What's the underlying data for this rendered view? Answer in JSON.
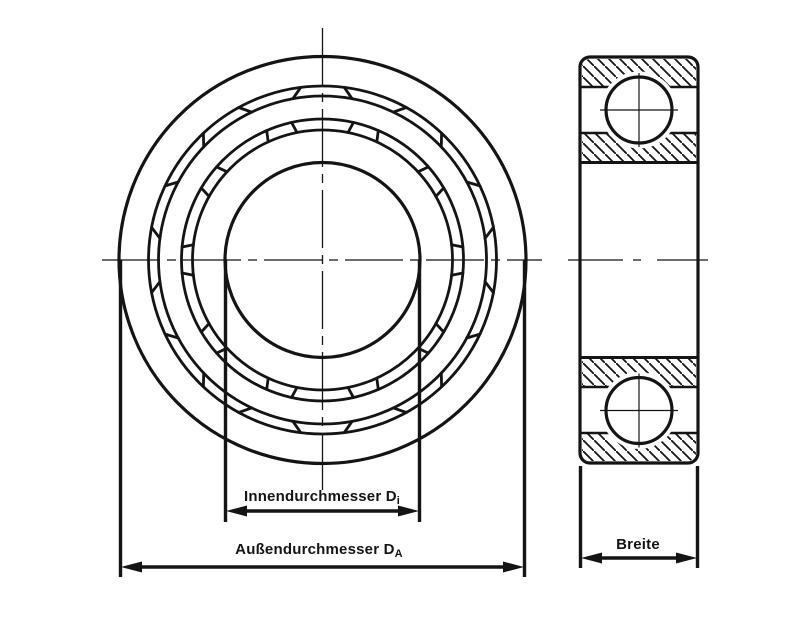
{
  "drawing": {
    "background": "#ffffff",
    "line_color": "#141414",
    "front_view": {
      "ball_positions": 10
    },
    "labels": {
      "inner_diameter": {
        "text": "Innendurchmesser D",
        "sub": "i"
      },
      "outer_diameter": {
        "text": "Außendurchmesser D",
        "sub": "A"
      },
      "width": {
        "text": "Breite"
      }
    }
  }
}
